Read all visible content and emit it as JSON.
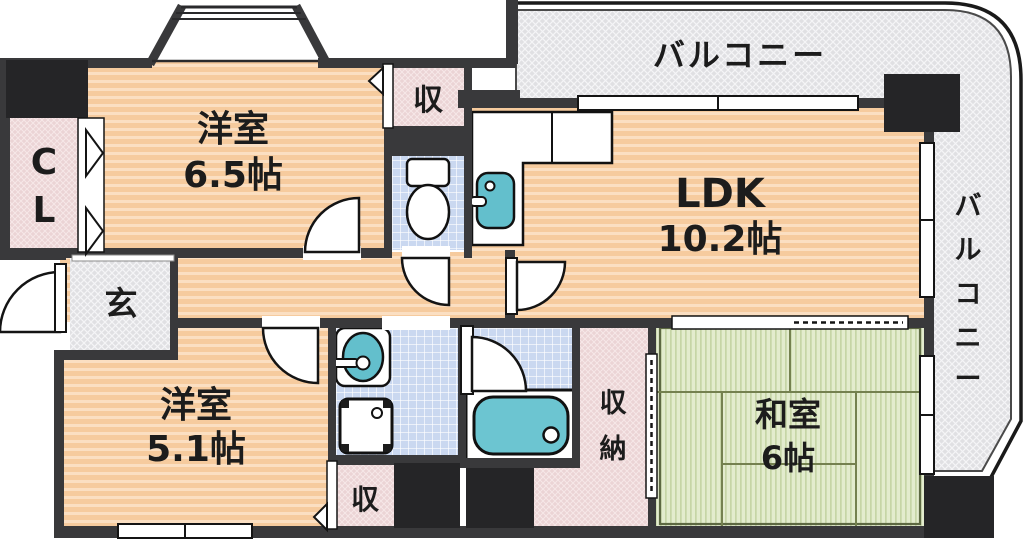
{
  "plan": {
    "title": "apartment floor plan",
    "rooms": {
      "western_6_5": {
        "name": "洋室",
        "size": "6.5帖"
      },
      "ldk": {
        "name": "LDK",
        "size": "10.2帖"
      },
      "western_5_1": {
        "name": "洋室",
        "size": "5.1帖"
      },
      "japanese_6": {
        "name": "和室",
        "size": "6帖"
      },
      "entrance": {
        "name": "玄"
      },
      "closet_cl": {
        "chars": [
          "C",
          "L"
        ]
      },
      "storage_top": {
        "name": "収"
      },
      "storage_bottom": {
        "name": "収"
      },
      "storage_closet": {
        "chars": [
          "収",
          "納"
        ]
      },
      "balcony_top": {
        "name": "バルコニー"
      },
      "balcony_right": {
        "chars": [
          "バ",
          "ル",
          "コ",
          "ニ",
          "ー"
        ]
      }
    },
    "colors": {
      "wall": "#39393b",
      "pillar": "#252527",
      "floor_orange": "#f6cb9e",
      "floor_orange_stripe": "#fbdfc2",
      "tatami_green": "#dfe9c9",
      "tile_blue": "#cad8f0",
      "closet_pink": "#ebd4d5",
      "balcony_gray": "#e2e2e4",
      "fixture_teal": "#63bfcc"
    }
  }
}
